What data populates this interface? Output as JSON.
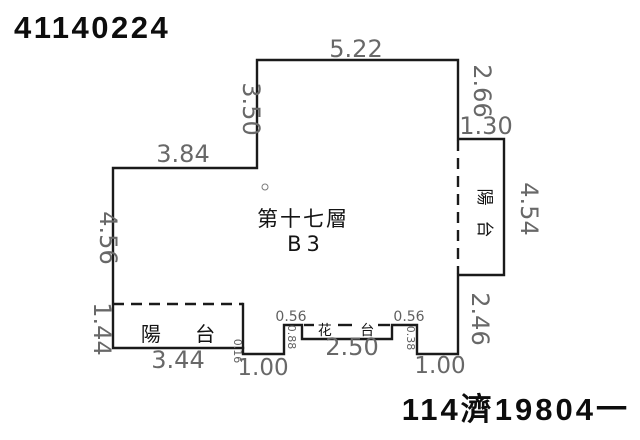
{
  "page": {
    "doc_number": "41140224",
    "case_number": "114濟19804一"
  },
  "plan": {
    "floor_label": "第十七層",
    "unit_label": "B3",
    "left_balcony_label": "陽 台",
    "right_balcony_char_top": "陽",
    "right_balcony_char_bottom": "台",
    "flower_bed_label": "花 台",
    "dims": {
      "top_width": "5.22",
      "upper_right_height": "2.66",
      "right_balcony_width": "1.30",
      "right_balcony_height": "4.54",
      "lower_right_height": "2.46",
      "upper_left_height": "3.50",
      "upper_left_width": "3.84",
      "left_height": "4.56",
      "left_balcony_height": "1.44",
      "left_balcony_width": "3.44",
      "left_step": "0.16",
      "bottom_left_offset": "1.00",
      "left_ledge_width": "0.56",
      "left_ledge_depth": "0.88",
      "flower_bed_width": "2.50",
      "right_ledge_width": "0.56",
      "right_ledge_depth": "0.38",
      "bottom_right_offset": "1.00"
    },
    "colors": {
      "wall": "#1a1a1a",
      "dimension_text": "#686868",
      "label_text": "#141414"
    }
  }
}
